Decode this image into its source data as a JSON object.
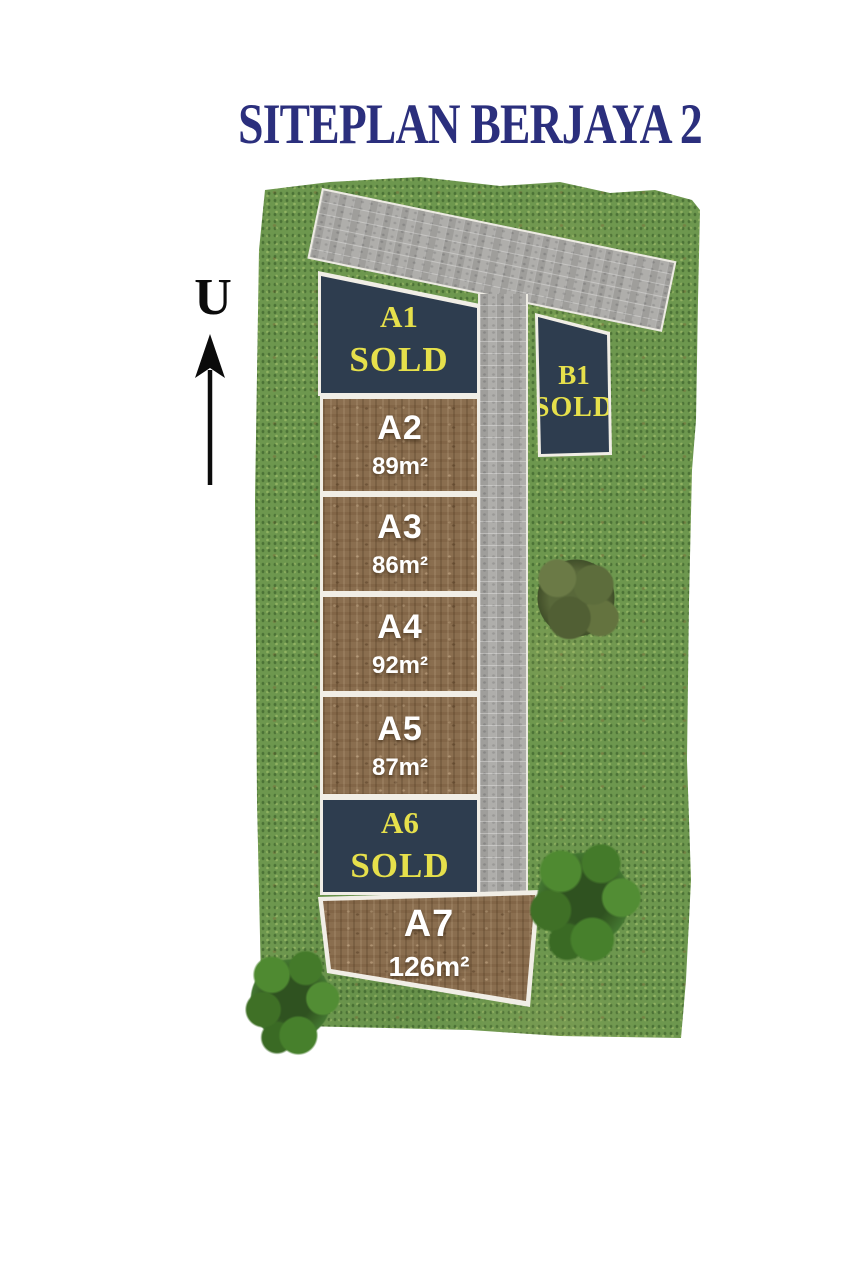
{
  "title": "SITEPLAN BERJAYA 2",
  "north": {
    "label": "U"
  },
  "plots": [
    {
      "id": "A1",
      "status": "SOLD",
      "type": "sold"
    },
    {
      "id": "A2",
      "area": "89m²",
      "type": "available"
    },
    {
      "id": "A3",
      "area": "86m²",
      "type": "available"
    },
    {
      "id": "A4",
      "area": "92m²",
      "type": "available"
    },
    {
      "id": "A5",
      "area": "87m²",
      "type": "available"
    },
    {
      "id": "A6",
      "status": "SOLD",
      "type": "sold"
    },
    {
      "id": "A7",
      "area": "126m²",
      "type": "available"
    },
    {
      "id": "B1",
      "status": "SOLD",
      "type": "sold"
    }
  ],
  "colors": {
    "title_text": "#2b2f7d",
    "sold_plot_bg": "#2e3d4f",
    "sold_text": "#e6e04b",
    "available_plot_soil": "#8a6e4f",
    "available_text": "#ffffff",
    "grass": "#6d974e",
    "road": "#a9a8a5",
    "boundary_line": "#f1eee6"
  }
}
